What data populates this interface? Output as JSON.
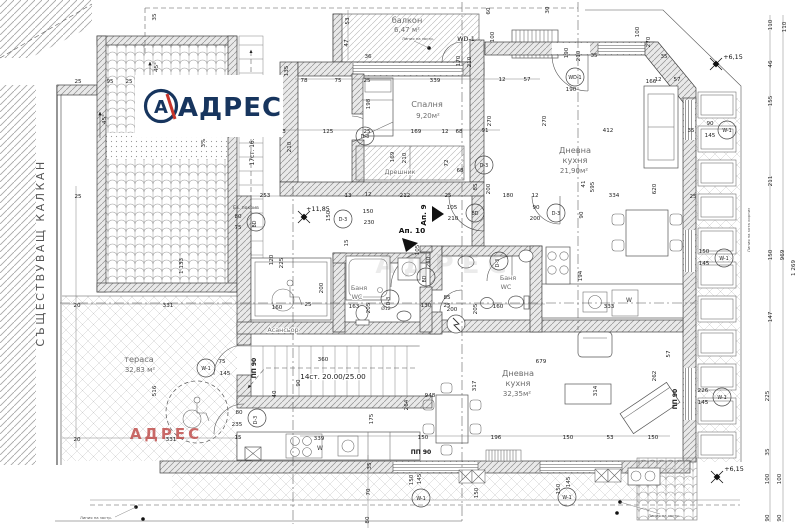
{
  "logo": {
    "brand": "АДРЕС",
    "mark": "А"
  },
  "watermark_red": "АДРЕС",
  "watermark_gray": "АДРЕС",
  "colors": {
    "navy": "#17355e",
    "red": "#c0504d",
    "line": "#3f3f3f"
  },
  "rooms": [
    {
      "name": "балкон",
      "area": "6,47 м²"
    },
    {
      "name": "Спалня",
      "area": "9,20м²"
    },
    {
      "name": "Дрешник",
      "area": ""
    },
    {
      "name": "Дневна кухня",
      "area": "21,90м²"
    },
    {
      "name": "Дневна кухня",
      "area": "32,35м²"
    },
    {
      "name": "тераса",
      "area": "32,83 м²"
    },
    {
      "name": "Асансьор",
      "area": ""
    },
    {
      "name": "Баня WC",
      "area": ""
    },
    {
      "name": "Баня WC",
      "area": ""
    }
  ],
  "texts": [
    {
      "t": "балкон",
      "x": 407,
      "y": 23,
      "c": "r"
    },
    {
      "t": "6,47 м²",
      "x": 407,
      "y": 32,
      "c": "a"
    },
    {
      "t": "Спалня",
      "x": 427,
      "y": 107,
      "c": "r"
    },
    {
      "t": "9,20м²",
      "x": 428,
      "y": 118,
      "c": "a"
    },
    {
      "t": "Дрешник",
      "x": 400,
      "y": 174,
      "c": "r2"
    },
    {
      "t": "Дневна",
      "x": 575,
      "y": 153,
      "c": "r"
    },
    {
      "t": "кухня",
      "x": 575,
      "y": 163,
      "c": "r"
    },
    {
      "t": "21,90м²",
      "x": 574,
      "y": 173,
      "c": "a"
    },
    {
      "t": "Дневна",
      "x": 518,
      "y": 376,
      "c": "r"
    },
    {
      "t": "кухня",
      "x": 518,
      "y": 386,
      "c": "r"
    },
    {
      "t": "32,35м²",
      "x": 517,
      "y": 396,
      "c": "a"
    },
    {
      "t": "тераса",
      "x": 139,
      "y": 362,
      "c": "r"
    },
    {
      "t": "32,83 м²",
      "x": 140,
      "y": 372,
      "c": "a"
    },
    {
      "t": "Асансьор",
      "x": 283,
      "y": 332,
      "c": "r2"
    },
    {
      "t": "Баня",
      "x": 359,
      "y": 290,
      "c": "r2"
    },
    {
      "t": "WC",
      "x": 357,
      "y": 299,
      "c": "r2"
    },
    {
      "t": "Баня",
      "x": 508,
      "y": 280,
      "c": "r2"
    },
    {
      "t": "WC",
      "x": 506,
      "y": 289,
      "c": "r2"
    },
    {
      "t": "Ап. 9",
      "x": 426,
      "y": 215,
      "r": -90,
      "c": "app"
    },
    {
      "t": "Ап. 10",
      "x": 412,
      "y": 233,
      "c": "app"
    },
    {
      "t": "СЪЩЕСТВУВАЩ КАЛКАН",
      "x": 44,
      "y": 253,
      "r": -90,
      "c": "side"
    },
    {
      "t": "14ст. 20.00/25.00",
      "x": 333,
      "y": 379,
      "c": "stair"
    },
    {
      "t": "17ст. 16.",
      "x": 254,
      "y": 152,
      "r": -90,
      "c": "stair2"
    },
    {
      "t": "3%",
      "x": 205,
      "y": 143,
      "r": -90,
      "c": "d"
    },
    {
      "t": "45°",
      "x": 158,
      "y": 67,
      "r": -90,
      "c": "d"
    },
    {
      "t": "45°",
      "x": 106,
      "y": 119,
      "r": -90,
      "c": "d"
    },
    {
      "t": "Ев. покрив",
      "x": 246,
      "y": 209,
      "c": "n2"
    },
    {
      "t": "WD-1",
      "x": 466,
      "y": 41,
      "c": "wd"
    },
    {
      "t": "ПП 90",
      "x": 256,
      "y": 368,
      "r": -90,
      "c": "pp"
    },
    {
      "t": "ПП 90",
      "x": 421,
      "y": 454,
      "c": "pp"
    },
    {
      "t": "ПП 90",
      "x": 677,
      "y": 399,
      "r": -90,
      "c": "pp"
    },
    {
      "t": "W",
      "x": 320,
      "y": 450,
      "c": "w"
    },
    {
      "t": "W",
      "x": 629,
      "y": 302,
      "c": "w"
    },
    {
      "t": "333",
      "x": 609,
      "y": 308,
      "c": "d"
    },
    {
      "t": "Ø12",
      "x": 386,
      "y": 310,
      "c": "n2"
    },
    {
      "t": "Линия на застр.",
      "x": 418,
      "y": 40,
      "c": "n"
    },
    {
      "t": "Линия на застр.",
      "x": 96,
      "y": 519,
      "c": "n"
    },
    {
      "t": "Линия на застр.",
      "x": 664,
      "y": 517,
      "c": "n"
    },
    {
      "t": "Линия на кота корниз",
      "x": 750,
      "y": 230,
      "r": -90,
      "c": "n"
    },
    {
      "t": "35",
      "x": 156,
      "y": 17,
      "r": -90,
      "c": "d"
    },
    {
      "t": "25",
      "x": 78,
      "y": 83,
      "c": "d"
    },
    {
      "t": "95",
      "x": 110,
      "y": 83,
      "c": "d"
    },
    {
      "t": "25",
      "x": 129,
      "y": 83,
      "c": "d"
    },
    {
      "t": "25",
      "x": 78,
      "y": 198,
      "c": "d"
    },
    {
      "t": "20",
      "x": 77,
      "y": 307,
      "c": "d"
    },
    {
      "t": "331",
      "x": 168,
      "y": 307,
      "c": "d"
    },
    {
      "t": "20",
      "x": 77,
      "y": 441,
      "c": "d"
    },
    {
      "t": "331",
      "x": 171,
      "y": 441,
      "c": "d"
    },
    {
      "t": "1 133",
      "x": 183,
      "y": 266,
      "r": -90,
      "c": "d"
    },
    {
      "t": "516",
      "x": 156,
      "y": 391,
      "r": -90,
      "c": "d"
    },
    {
      "t": "75",
      "x": 222,
      "y": 363,
      "c": "d"
    },
    {
      "t": "145",
      "x": 225,
      "y": 375,
      "c": "d"
    },
    {
      "t": "80",
      "x": 239,
      "y": 414,
      "c": "d"
    },
    {
      "t": "235",
      "x": 237,
      "y": 426,
      "c": "d"
    },
    {
      "t": "80",
      "x": 238,
      "y": 218,
      "c": "d"
    },
    {
      "t": "75",
      "x": 238,
      "y": 229,
      "c": "d"
    },
    {
      "t": "53",
      "x": 349,
      "y": 21,
      "r": -90,
      "c": "d"
    },
    {
      "t": "47",
      "x": 348,
      "y": 43,
      "r": -90,
      "c": "d"
    },
    {
      "t": "36",
      "x": 368,
      "y": 58,
      "c": "d"
    },
    {
      "t": "135",
      "x": 288,
      "y": 71,
      "r": -90,
      "c": "d"
    },
    {
      "t": "78",
      "x": 304,
      "y": 82,
      "c": "d"
    },
    {
      "t": "75",
      "x": 338,
      "y": 82,
      "c": "d"
    },
    {
      "t": "25",
      "x": 367,
      "y": 82,
      "c": "d"
    },
    {
      "t": "339",
      "x": 435,
      "y": 82,
      "c": "d"
    },
    {
      "t": "12",
      "x": 502,
      "y": 81,
      "c": "d"
    },
    {
      "t": "57",
      "x": 527,
      "y": 81,
      "c": "d"
    },
    {
      "t": "12",
      "x": 658,
      "y": 81,
      "c": "d"
    },
    {
      "t": "57",
      "x": 677,
      "y": 81,
      "c": "d"
    },
    {
      "t": "170",
      "x": 460,
      "y": 61,
      "r": -90,
      "c": "d"
    },
    {
      "t": "210",
      "x": 471,
      "y": 62,
      "r": -90,
      "c": "d"
    },
    {
      "t": "100",
      "x": 494,
      "y": 37,
      "r": -90,
      "c": "d"
    },
    {
      "t": "60",
      "x": 490,
      "y": 11,
      "r": -90,
      "c": "d"
    },
    {
      "t": "30",
      "x": 549,
      "y": 10,
      "r": -90,
      "c": "d"
    },
    {
      "t": "100",
      "x": 639,
      "y": 32,
      "r": -90,
      "c": "d"
    },
    {
      "t": "270",
      "x": 650,
      "y": 42,
      "r": -90,
      "c": "d"
    },
    {
      "t": "190",
      "x": 568,
      "y": 53,
      "r": -90,
      "c": "d"
    },
    {
      "t": "210",
      "x": 580,
      "y": 56,
      "r": -90,
      "c": "d"
    },
    {
      "t": "35",
      "x": 594,
      "y": 57,
      "c": "d"
    },
    {
      "t": "35",
      "x": 664,
      "y": 58,
      "c": "d"
    },
    {
      "t": "190",
      "x": 571,
      "y": 91,
      "c": "d"
    },
    {
      "t": "166",
      "x": 651,
      "y": 83,
      "c": "d"
    },
    {
      "t": "412",
      "x": 608,
      "y": 132,
      "c": "d"
    },
    {
      "t": "270",
      "x": 491,
      "y": 121,
      "r": -90,
      "c": "d"
    },
    {
      "t": "270",
      "x": 546,
      "y": 121,
      "r": -90,
      "c": "d"
    },
    {
      "t": "198",
      "x": 370,
      "y": 104,
      "r": -90,
      "c": "d"
    },
    {
      "t": "3",
      "x": 284,
      "y": 133,
      "c": "d"
    },
    {
      "t": "125",
      "x": 328,
      "y": 133,
      "c": "d"
    },
    {
      "t": "210",
      "x": 291,
      "y": 147,
      "r": -90,
      "c": "d"
    },
    {
      "t": "25",
      "x": 367,
      "y": 133,
      "c": "d"
    },
    {
      "t": "169",
      "x": 416,
      "y": 133,
      "c": "d"
    },
    {
      "t": "12",
      "x": 445,
      "y": 133,
      "c": "d"
    },
    {
      "t": "68",
      "x": 459,
      "y": 133,
      "c": "d"
    },
    {
      "t": "91",
      "x": 485,
      "y": 132,
      "c": "d"
    },
    {
      "t": "169",
      "x": 394,
      "y": 157,
      "r": -90,
      "c": "d"
    },
    {
      "t": "210",
      "x": 406,
      "y": 158,
      "r": -90,
      "c": "d"
    },
    {
      "t": "72",
      "x": 448,
      "y": 163,
      "r": -90,
      "c": "d"
    },
    {
      "t": "68",
      "x": 460,
      "y": 172,
      "c": "d"
    },
    {
      "t": "85",
      "x": 477,
      "y": 187,
      "r": -90,
      "c": "d"
    },
    {
      "t": "200",
      "x": 490,
      "y": 189,
      "r": -90,
      "c": "d"
    },
    {
      "t": "110",
      "x": 772,
      "y": 25,
      "r": -90,
      "c": "d"
    },
    {
      "t": "110",
      "x": 786,
      "y": 27,
      "r": -90,
      "c": "d"
    },
    {
      "t": "46",
      "x": 772,
      "y": 64,
      "r": -90,
      "c": "d"
    },
    {
      "t": "155",
      "x": 772,
      "y": 101,
      "r": -90,
      "c": "d"
    },
    {
      "t": "211",
      "x": 772,
      "y": 181,
      "r": -90,
      "c": "d"
    },
    {
      "t": "150",
      "x": 772,
      "y": 255,
      "r": -90,
      "c": "d"
    },
    {
      "t": "147",
      "x": 772,
      "y": 317,
      "r": -90,
      "c": "d"
    },
    {
      "t": "969",
      "x": 784,
      "y": 255,
      "r": -90,
      "c": "d"
    },
    {
      "t": "1 269",
      "x": 795,
      "y": 268,
      "r": -90,
      "c": "d"
    },
    {
      "t": "90",
      "x": 710,
      "y": 125,
      "c": "d"
    },
    {
      "t": "145",
      "x": 710,
      "y": 137,
      "c": "d"
    },
    {
      "t": "150",
      "x": 704,
      "y": 253,
      "c": "d"
    },
    {
      "t": "145",
      "x": 704,
      "y": 265,
      "c": "d"
    },
    {
      "t": "226",
      "x": 703,
      "y": 392,
      "c": "d"
    },
    {
      "t": "145",
      "x": 703,
      "y": 404,
      "c": "d"
    },
    {
      "t": "35",
      "x": 691,
      "y": 132,
      "c": "d"
    },
    {
      "t": "25",
      "x": 693,
      "y": 198,
      "c": "d"
    },
    {
      "t": "253",
      "x": 265,
      "y": 197,
      "c": "d"
    },
    {
      "t": "13",
      "x": 348,
      "y": 197,
      "c": "d"
    },
    {
      "t": "12",
      "x": 368,
      "y": 196,
      "c": "d"
    },
    {
      "t": "212",
      "x": 405,
      "y": 197,
      "c": "d"
    },
    {
      "t": "25",
      "x": 448,
      "y": 197,
      "c": "d"
    },
    {
      "t": "180",
      "x": 508,
      "y": 197,
      "c": "d"
    },
    {
      "t": "12",
      "x": 535,
      "y": 197,
      "c": "d"
    },
    {
      "t": "150",
      "x": 330,
      "y": 216,
      "r": -90,
      "c": "d"
    },
    {
      "t": "15",
      "x": 348,
      "y": 243,
      "r": -90,
      "c": "d"
    },
    {
      "t": "150",
      "x": 368,
      "y": 213,
      "c": "d"
    },
    {
      "t": "230",
      "x": 369,
      "y": 224,
      "c": "d"
    },
    {
      "t": "105",
      "x": 452,
      "y": 209,
      "c": "d"
    },
    {
      "t": "210",
      "x": 453,
      "y": 220,
      "c": "d"
    },
    {
      "t": "90",
      "x": 536,
      "y": 209,
      "c": "d"
    },
    {
      "t": "200",
      "x": 535,
      "y": 220,
      "c": "d"
    },
    {
      "t": "41",
      "x": 585,
      "y": 184,
      "r": -90,
      "c": "d"
    },
    {
      "t": "595",
      "x": 594,
      "y": 187,
      "r": -90,
      "c": "d"
    },
    {
      "t": "620",
      "x": 656,
      "y": 189,
      "r": -90,
      "c": "d"
    },
    {
      "t": "334",
      "x": 614,
      "y": 197,
      "c": "d"
    },
    {
      "t": "90",
      "x": 583,
      "y": 215,
      "r": -90,
      "c": "d"
    },
    {
      "t": "194",
      "x": 582,
      "y": 276,
      "r": -90,
      "c": "d"
    },
    {
      "t": "120",
      "x": 273,
      "y": 260,
      "r": -90,
      "c": "d"
    },
    {
      "t": "225",
      "x": 283,
      "y": 263,
      "r": -90,
      "c": "d"
    },
    {
      "t": "200",
      "x": 323,
      "y": 288,
      "r": -90,
      "c": "d"
    },
    {
      "t": "160",
      "x": 277,
      "y": 309,
      "c": "d"
    },
    {
      "t": "25",
      "x": 308,
      "y": 306,
      "c": "d"
    },
    {
      "t": "163",
      "x": 354,
      "y": 308,
      "c": "d"
    },
    {
      "t": "205",
      "x": 370,
      "y": 308,
      "r": -90,
      "c": "d"
    },
    {
      "t": "85",
      "x": 447,
      "y": 299,
      "c": "d"
    },
    {
      "t": "200",
      "x": 452,
      "y": 311,
      "c": "d"
    },
    {
      "t": "105",
      "x": 419,
      "y": 250,
      "r": -90,
      "c": "d"
    },
    {
      "t": "210",
      "x": 430,
      "y": 262,
      "r": -90,
      "c": "d"
    },
    {
      "t": "130",
      "x": 426,
      "y": 307,
      "c": "d"
    },
    {
      "t": "25",
      "x": 447,
      "y": 307,
      "c": "d"
    },
    {
      "t": "160",
      "x": 498,
      "y": 308,
      "c": "d"
    },
    {
      "t": "205",
      "x": 477,
      "y": 309,
      "r": -90,
      "c": "d"
    },
    {
      "t": "679",
      "x": 541,
      "y": 363,
      "c": "d"
    },
    {
      "t": "314",
      "x": 597,
      "y": 391,
      "r": -90,
      "c": "d"
    },
    {
      "t": "262",
      "x": 656,
      "y": 376,
      "r": -90,
      "c": "d"
    },
    {
      "t": "57",
      "x": 670,
      "y": 354,
      "r": -90,
      "c": "d"
    },
    {
      "t": "317",
      "x": 476,
      "y": 386,
      "r": -90,
      "c": "d"
    },
    {
      "t": "948",
      "x": 430,
      "y": 397,
      "c": "d"
    },
    {
      "t": "264",
      "x": 408,
      "y": 405,
      "r": -90,
      "c": "d"
    },
    {
      "t": "175",
      "x": 373,
      "y": 419,
      "r": -90,
      "c": "d"
    },
    {
      "t": "360",
      "x": 323,
      "y": 361,
      "c": "d"
    },
    {
      "t": "90",
      "x": 300,
      "y": 383,
      "r": -90,
      "c": "d"
    },
    {
      "t": "40",
      "x": 276,
      "y": 394,
      "r": -90,
      "c": "d"
    },
    {
      "t": "15",
      "x": 238,
      "y": 439,
      "c": "d"
    },
    {
      "t": "339",
      "x": 319,
      "y": 440,
      "c": "d"
    },
    {
      "t": "150",
      "x": 423,
      "y": 439,
      "c": "d"
    },
    {
      "t": "196",
      "x": 496,
      "y": 439,
      "c": "d"
    },
    {
      "t": "150",
      "x": 568,
      "y": 439,
      "c": "d"
    },
    {
      "t": "53",
      "x": 610,
      "y": 439,
      "c": "d"
    },
    {
      "t": "150",
      "x": 653,
      "y": 439,
      "c": "d"
    },
    {
      "t": "35",
      "x": 371,
      "y": 466,
      "r": -90,
      "c": "d"
    },
    {
      "t": "70",
      "x": 370,
      "y": 492,
      "r": -90,
      "c": "d"
    },
    {
      "t": "80",
      "x": 369,
      "y": 520,
      "r": -90,
      "c": "d"
    },
    {
      "t": "150",
      "x": 413,
      "y": 480,
      "r": -90,
      "c": "d"
    },
    {
      "t": "145",
      "x": 421,
      "y": 479,
      "r": -90,
      "c": "d"
    },
    {
      "t": "150",
      "x": 478,
      "y": 493,
      "r": -90,
      "c": "d"
    },
    {
      "t": "145",
      "x": 570,
      "y": 482,
      "r": -90,
      "c": "d"
    },
    {
      "t": "150",
      "x": 560,
      "y": 489,
      "r": -90,
      "c": "d"
    },
    {
      "t": "225",
      "x": 769,
      "y": 396,
      "r": -90,
      "c": "d"
    },
    {
      "t": "35",
      "x": 769,
      "y": 452,
      "r": -90,
      "c": "d"
    },
    {
      "t": "100",
      "x": 769,
      "y": 479,
      "r": -90,
      "c": "d"
    },
    {
      "t": "90",
      "x": 769,
      "y": 518,
      "r": -90,
      "c": "d"
    },
    {
      "t": "100",
      "x": 781,
      "y": 479,
      "r": -90,
      "c": "d"
    },
    {
      "t": "90",
      "x": 781,
      "y": 518,
      "r": -90,
      "c": "d"
    }
  ],
  "tags": [
    {
      "t": "WD-1",
      "x": 575,
      "y": 77
    },
    {
      "t": "W-1",
      "x": 727,
      "y": 130
    },
    {
      "t": "W-1",
      "x": 724,
      "y": 258
    },
    {
      "t": "W-1",
      "x": 722,
      "y": 397
    },
    {
      "t": "W-1",
      "x": 206,
      "y": 368
    },
    {
      "t": "W-1",
      "x": 421,
      "y": 498
    },
    {
      "t": "W-1",
      "x": 567,
      "y": 497
    },
    {
      "t": "D-3",
      "x": 365,
      "y": 136
    },
    {
      "t": "D-3",
      "x": 484,
      "y": 165
    },
    {
      "t": "D-3",
      "x": 556,
      "y": 213
    },
    {
      "t": "D-3",
      "x": 343,
      "y": 219
    },
    {
      "t": "D-3",
      "x": 390,
      "y": 299,
      "r": -90
    },
    {
      "t": "D-3",
      "x": 499,
      "y": 261,
      "r": -90
    },
    {
      "t": "D-3",
      "x": 257,
      "y": 418,
      "r": -90
    },
    {
      "t": "BD",
      "x": 256,
      "y": 222,
      "r": -90
    },
    {
      "t": "BD",
      "x": 475,
      "y": 213
    },
    {
      "t": "BD",
      "x": 426,
      "y": 277,
      "r": -90
    }
  ],
  "levels": [
    {
      "t": "+11,85",
      "x": 318,
      "y": 211,
      "sx": 304,
      "sy": 217
    },
    {
      "t": "+6,15",
      "x": 733,
      "y": 59,
      "sx": 716,
      "sy": 64
    },
    {
      "t": "+6,15",
      "x": 734,
      "y": 471,
      "sx": 717,
      "sy": 477
    }
  ]
}
